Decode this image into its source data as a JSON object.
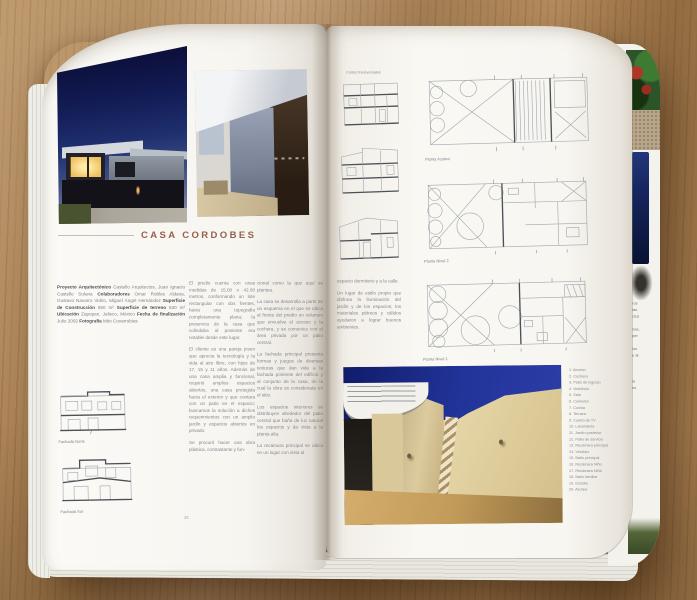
{
  "magazine": {
    "left_page": {
      "title": "CASA CORDOBES",
      "credits": [
        {
          "t": "Proyecto Arquitectónico ",
          "b": true
        },
        {
          "t": "Castello Arquitectos, Juan Ignacio Castello Solana ",
          "b": false
        },
        {
          "t": "Colaboradores ",
          "b": true
        },
        {
          "t": "Omar Robles Aldana, Gustavo Navarro Vidrio, Miguel Ángel Hernández ",
          "b": false
        },
        {
          "t": "Superficie de Construcción ",
          "b": true
        },
        {
          "t": "650 m² ",
          "b": false
        },
        {
          "t": "Superficie de terreno ",
          "b": true
        },
        {
          "t": "630 m² ",
          "b": false
        },
        {
          "t": "Ubicación ",
          "b": true
        },
        {
          "t": "Zapopan, Jalisco, México ",
          "b": false
        },
        {
          "t": "Fecha de finalización ",
          "b": true
        },
        {
          "t": "Julio 2002 ",
          "b": false
        },
        {
          "t": "Fotografía ",
          "b": true
        },
        {
          "t": "Mito Covarrubias",
          "b": false
        }
      ],
      "column2": [
        "El predio cuenta con unas medidas de 15.00 x 42.00 metros, conformando un lote rectangular con dos frentes, hacia una topografía completamente plana; la presencia de la casa que colindaba al poniente era notable desde este lugar.",
        "El cliente es una pareja joven que aprecia la tecnología y la vida al aire libre, con hijos de 17, 15 y 11 años. Además de una casa amplia y funcional, requirió amplios espacios abiertos, una casa protegida hacia el exterior y que contara con un patio en el espacio; buscamos la solución a dichos requerimientos con un amplio jardín y espacios abiertos en privado.",
        "Se procuró hacer una obra plástica, contrastante y fun-"
      ],
      "column3": [
        "cional como la que aquí se plantea.",
        "La casa se desarrolla a partir de un esquema en el que se ubica al frente del predio un volumen que envuelve el acceso y la cochera, y se comunica con el área privada por un patio central.",
        "La fachada principal presenta formas y juegos de diversas texturas que dan vida a la fachada poniente del edificio y al conjunto de la casa, de la cual la obra es considerada en el sitio.",
        "Los espacios interiores se distribuyen alrededor del patio central que baña de luz natural los espacios y da vista a la planta alta.",
        "La recámara principal se ubica en un lugar con vista al"
      ],
      "drawing_captions": [
        "Fachada Norte",
        "Fachada Sur"
      ],
      "page_mark": "36"
    },
    "right_page": {
      "sections_caption": "Cortes transversales",
      "plan_labels": [
        "Planta Azotea",
        "Planta Nivel 2",
        "Planta Nivel 1"
      ],
      "column": [
        "espacio dormitorio y a la calle.",
        "Un lugar de estilo propio que disfruta la iluminación del jardín y de los espacios; los materiales pétreos y cálidos ayudaron a lograr buenos ambientes."
      ],
      "legend": [
        "1. Acceso",
        "2. Cochera",
        "3. Patio de ingreso",
        "4. Vestíbulo",
        "5. Sala",
        "6. Comedor",
        "7. Cocina",
        "8. Terraza",
        "9. Cuarto de TV",
        "10. Lavandería",
        "11. Jardín posterior",
        "12. Patio de servicio",
        "13. Recámara principal",
        "14. Vestidor",
        "15. Baño principal",
        "16. Recámara Niño",
        "17. Recámara Niña",
        "18. Baño familiar",
        "19. Estudio",
        "20. Azotea"
      ]
    },
    "next_page_fragments": [
      "ros",
      "las",
      "cica",
      "",
      "nsa,",
      "per",
      "",
      "los",
      "e al",
      "",
      "",
      "",
      "te",
      "es"
    ],
    "colors": {
      "title_accent": "#96604f",
      "page": "#f6f4ef",
      "wood": "#a9845a",
      "dusk_sky": "#111a52",
      "day_sky": "#22349a",
      "wall_cream": "#e4d4a5"
    }
  }
}
